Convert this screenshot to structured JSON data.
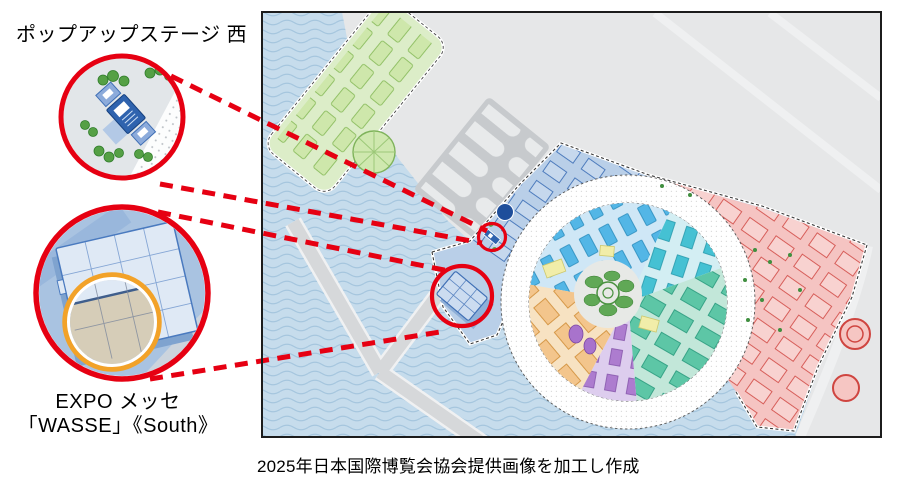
{
  "colors": {
    "annotation_red": "#e60012",
    "highlight_orange": "#f2a229",
    "text": "#000000",
    "frame": "#1c1c1c"
  },
  "labels": {
    "popup_stage": "ポップアップステージ 西",
    "expo_messe_line1": "EXPO メッセ",
    "expo_messe_line2": "「WASSE」《South》",
    "caption": "2025年日本国際博覧会協会提供画像を加工し作成"
  },
  "map": {
    "zone_colors": {
      "water": "#c6dcec",
      "land": "#e6e7e8",
      "land_dark": "#c7cacd",
      "green_zone": "#dcedc8",
      "outer_blue_band": "#b9cfe8",
      "west_entrance_blue": "#b9cfe8",
      "outer_pink_band": "#f5c4c2",
      "ring": "#ffffff",
      "interior_blue": "#cfe7f6",
      "interior_cyan": "#d3eef3",
      "interior_teal": "#c2e7d9",
      "interior_purple": "#ddcdee",
      "interior_orange": "#f7e2c2",
      "center_forest": "#60a856"
    },
    "markers": {
      "popup_stage_west": {
        "shape": "circle",
        "color": "#e60012"
      },
      "expo_messe_wasse": {
        "shape": "circle",
        "color": "#e60012"
      }
    }
  }
}
